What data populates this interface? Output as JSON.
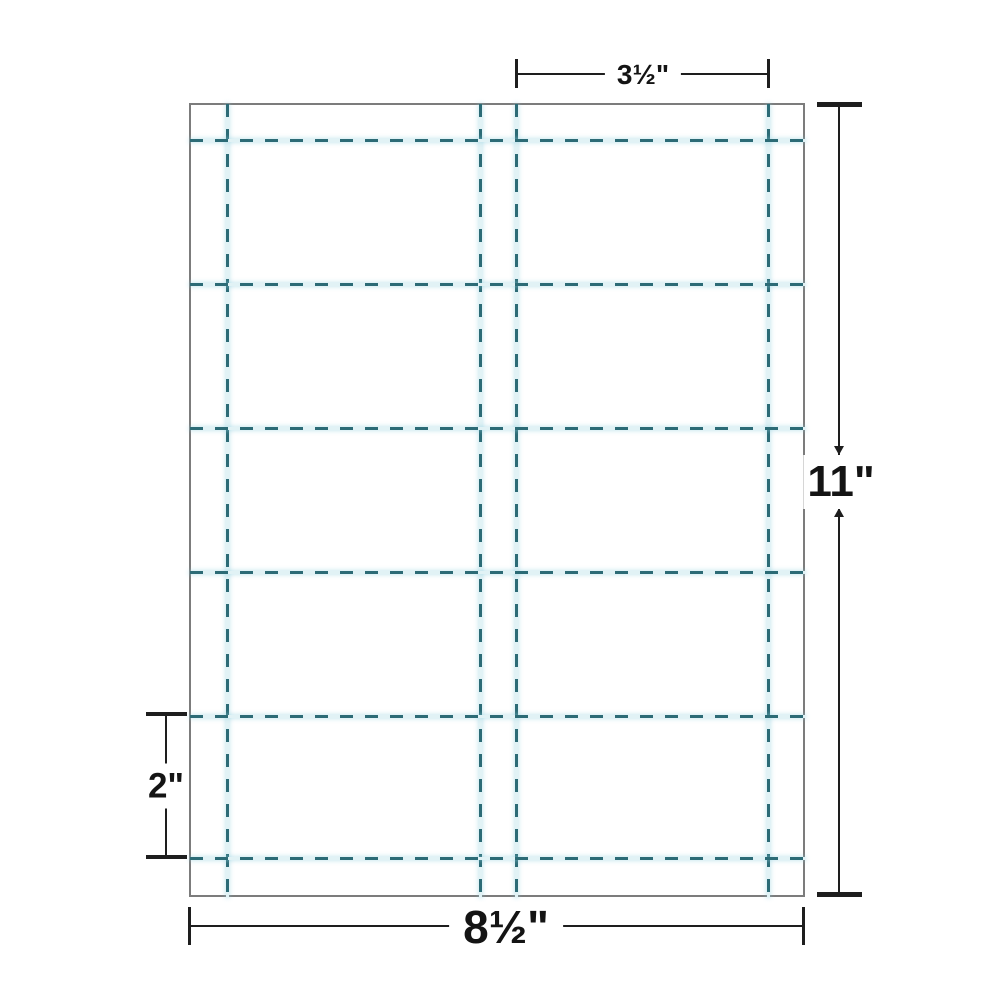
{
  "diagram": {
    "sheet": {
      "grid": {
        "rows": 5,
        "columns": 2,
        "card_count": 10
      },
      "dimensions": {
        "card_width": {
          "label": "3½\""
        },
        "sheet_height": {
          "label": "11\""
        },
        "card_height": {
          "label": "2\""
        },
        "sheet_width": {
          "label": "8½\""
        }
      }
    },
    "colors": {
      "perforation_dash": "#2c6b76",
      "perforation_halo": "#e1f2f5",
      "sheet_border": "#7c7c7c",
      "dimension_line": "#1e1e1e",
      "background": "#ffffff"
    }
  }
}
